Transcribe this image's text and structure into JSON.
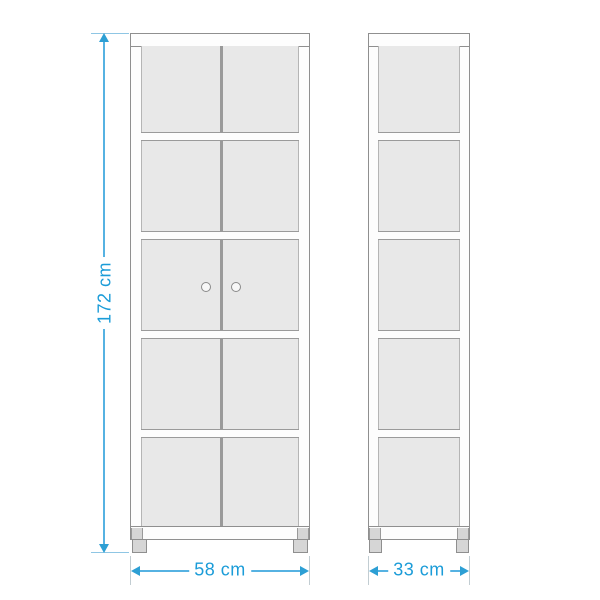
{
  "diagram": {
    "dimensions": {
      "height": "172 cm",
      "width": "58 cm",
      "depth": "33 cm"
    },
    "views": {
      "front": {
        "compartments": 5,
        "doors": 2,
        "knobs": 2,
        "feet": 2
      },
      "side": {
        "compartments": 5,
        "feet": 2
      }
    },
    "colors": {
      "dimension_text": "#1b9cd8",
      "dimension_line": "#56b2e2",
      "dimension_arrow": "#2d9fd4",
      "extension_line": "#c2cdd2",
      "outline": "#8f8f8f",
      "panel_fill": "#e8e8e8",
      "foot_fill": "#d6d6d6"
    }
  }
}
